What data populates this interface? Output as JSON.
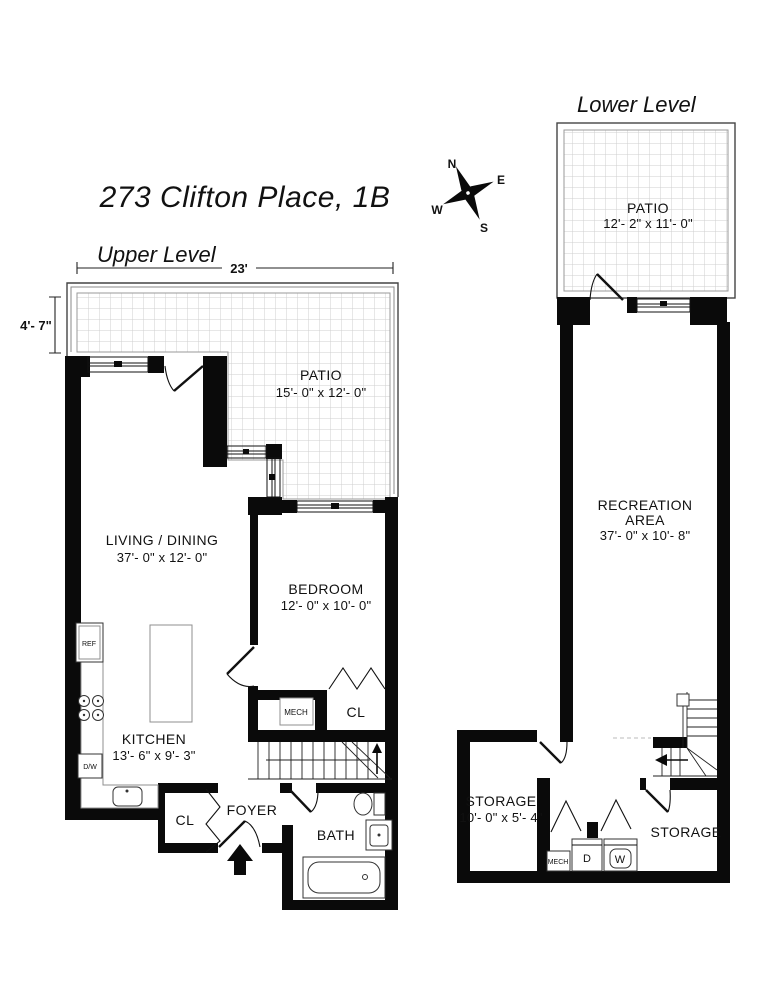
{
  "title": "273 Clifton Place, 1B",
  "compass": {
    "n": "N",
    "e": "E",
    "s": "S",
    "w": "W"
  },
  "upper": {
    "label": "Upper Level",
    "dim_width": "23'",
    "dim_patio_depth": "4'- 7\"",
    "patio": {
      "name": "PATIO",
      "dims": "15'- 0\" x 12'- 0\""
    },
    "living": {
      "name": "LIVING / DINING",
      "dims": "37'- 0\" x 12'- 0\""
    },
    "bedroom": {
      "name": "BEDROOM",
      "dims": "12'- 0\" x 10'- 0\""
    },
    "kitchen": {
      "name": "KITCHEN",
      "dims": "13'- 6\" x 9'- 3\""
    },
    "mech": "MECH",
    "closet_bedroom": "CL",
    "closet_foyer": "CL",
    "foyer": "FOYER",
    "bath": "BATH",
    "fridge": "REF",
    "dishwasher": "D/W"
  },
  "lower": {
    "label": "Lower Level",
    "patio": {
      "name": "PATIO",
      "dims": "12'- 2\" x 11'- 0\""
    },
    "recreation": {
      "line1": "RECREATION",
      "line2": "AREA",
      "dims": "37'- 0\" x 10'- 8\""
    },
    "storage_left": {
      "name": "STORAGE",
      "dims": "10'- 0\" x 5'- 4\""
    },
    "storage_right": {
      "name": "STORAGE"
    },
    "mech": "MECH",
    "dryer": "D",
    "washer": "W"
  },
  "colors": {
    "wall": "#0a0a0a",
    "grid": "#cfcfcf",
    "background": "#ffffff"
  }
}
